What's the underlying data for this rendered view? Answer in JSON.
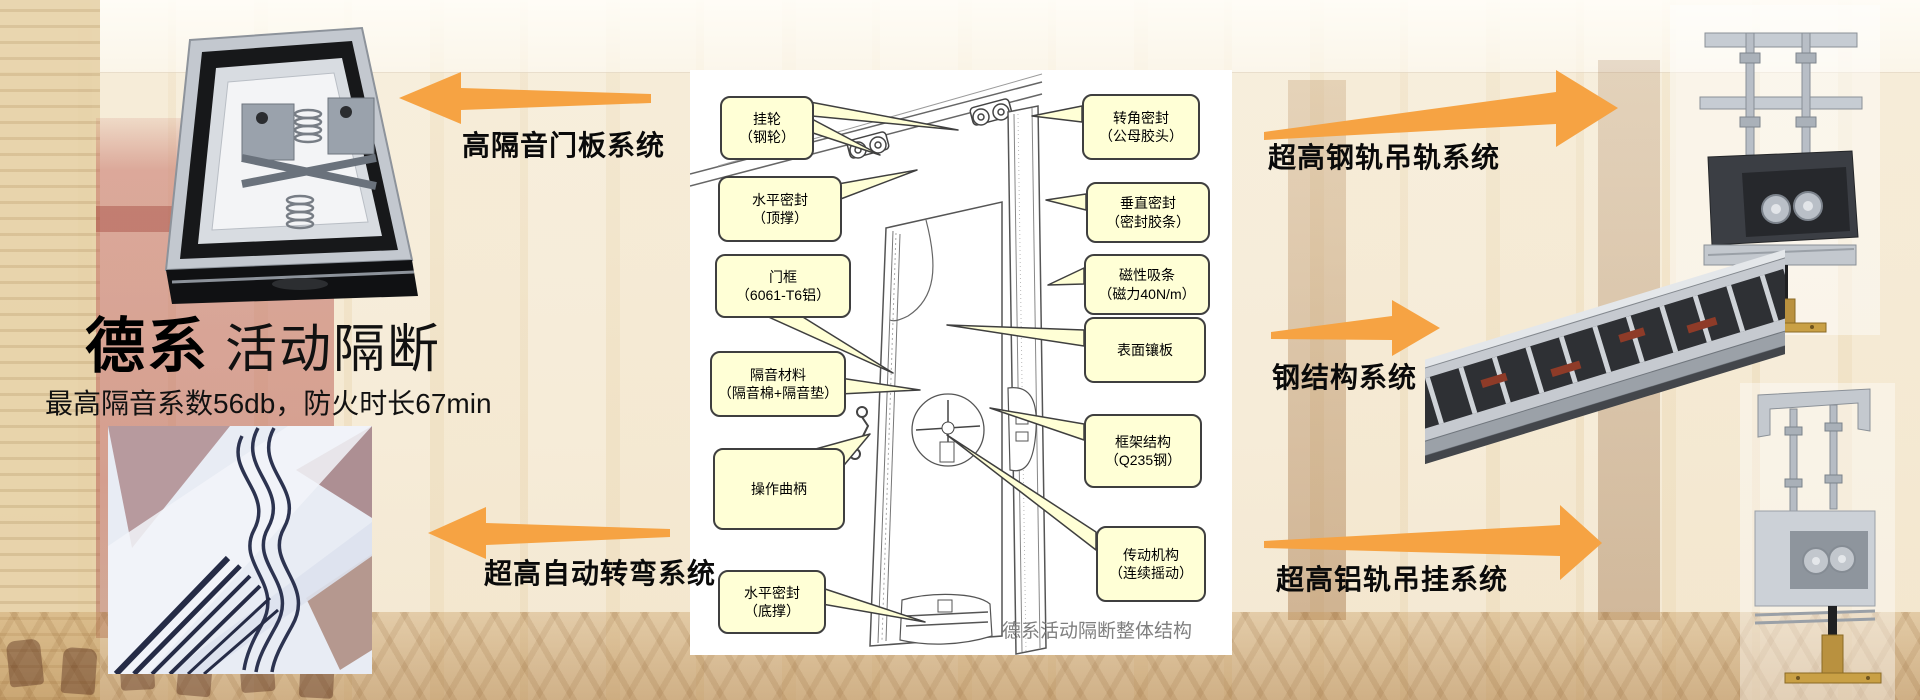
{
  "slide": {
    "title_bold": "德系",
    "title_regular": "活动隔断",
    "subtitle": "最高隔音系数56db，防火时长67min"
  },
  "systems": [
    {
      "label": "高隔音门板系统",
      "direction": "left"
    },
    {
      "label": "超高自动转弯系统",
      "direction": "left"
    },
    {
      "label": "超高钢轨吊轨系统",
      "direction": "right"
    },
    {
      "label": "钢结构系统",
      "direction": "right"
    },
    {
      "label": "超高铝轨吊挂系统",
      "direction": "right"
    }
  ],
  "diagram": {
    "caption": "德系活动隔断整体结构",
    "left_callouts": [
      {
        "line1": "挂轮",
        "line2": "（钢轮）"
      },
      {
        "line1": "水平密封",
        "line2": "（顶撑）"
      },
      {
        "line1": "门框",
        "line2": "（6061-T6铝）"
      },
      {
        "line1": "隔音材料",
        "line2": "（隔音棉+隔音垫）"
      },
      {
        "line1": "操作曲柄",
        "line2": ""
      },
      {
        "line1": "水平密封",
        "line2": "（底撑）"
      }
    ],
    "right_callouts": [
      {
        "line1": "转角密封",
        "line2": "（公母胶头）"
      },
      {
        "line1": "垂直密封",
        "line2": "（密封胶条）"
      },
      {
        "line1": "磁性吸条",
        "line2": "（磁力40N/m）"
      },
      {
        "line1": "表面镶板",
        "line2": ""
      },
      {
        "line1": "框架结构",
        "line2": "（Q235钢）"
      },
      {
        "line1": "传动机构",
        "line2": "（连续摇动）"
      }
    ]
  },
  "photos": [
    {
      "name": "door-panel-mechanism-photo"
    },
    {
      "name": "curved-track-detail-photo"
    },
    {
      "name": "steel-rail-hanger-photo"
    },
    {
      "name": "steel-structure-frame-photo"
    },
    {
      "name": "aluminum-rail-hanger-photo"
    }
  ],
  "colors": {
    "arrow_orange": "#F6A343",
    "callout_fill": "#FFFFD6",
    "callout_border": "#3F3F3F",
    "caption_gray": "#7F7F7F",
    "text_black": "#000000",
    "panel_white": "#FFFFFF"
  }
}
